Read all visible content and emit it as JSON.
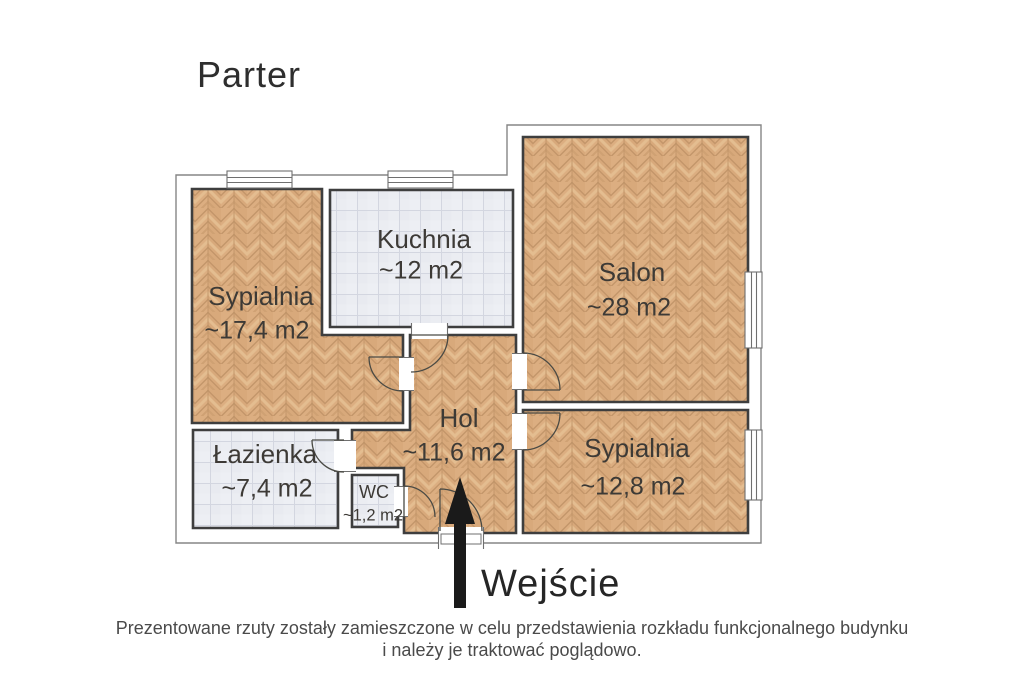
{
  "page": {
    "title": "Parter",
    "entrance_label": "Wejście",
    "footer_line1": "Prezentowane rzuty zostały zamieszczone w celu przedstawienia rozkładu funkcjonalnego budynku",
    "footer_line2": "i należy je traktować poglądowo."
  },
  "rooms": [
    {
      "name": "Sypialnia",
      "area": "~17,4 m2",
      "floor": "wood"
    },
    {
      "name": "Kuchnia",
      "area": "~12 m2",
      "floor": "tile"
    },
    {
      "name": "Salon",
      "area": "~28 m2",
      "floor": "wood"
    },
    {
      "name": "Hol",
      "area": "~11,6 m2",
      "floor": "wood"
    },
    {
      "name": "Łazienka",
      "area": "~7,4 m2",
      "floor": "tile"
    },
    {
      "name": "WC",
      "area": "~1,2 m2",
      "floor": "tile"
    },
    {
      "name": "Sypialnia",
      "area": "~12,8 m2",
      "floor": "wood"
    }
  ],
  "colors": {
    "wood_base": "#d8a97b",
    "wood_plank_dark": "#c3966a",
    "wood_plank_light": "#e4bd90",
    "tile_base": "#ebedf2",
    "tile_grid": "#d3d6e0",
    "wall_dark": "#3e3e3e",
    "outline_gray": "#858585",
    "arrow_black": "#1a1a1a",
    "text_dark": "#3d3a36"
  }
}
